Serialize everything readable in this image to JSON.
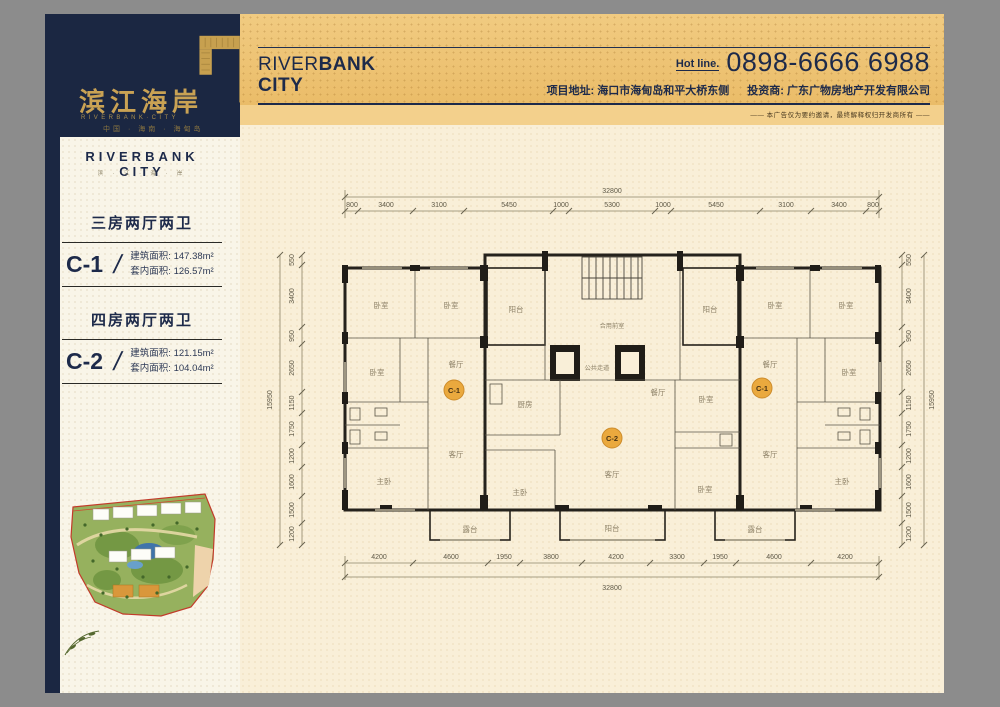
{
  "brand": {
    "logo_cn": "滨江海岸",
    "logo_en": "RIVERBANK·CITY",
    "logo_sub": "中国 · 海南 · 海甸岛",
    "navy": "#1b2742",
    "gold": "#c9a254"
  },
  "banner": {
    "brand_part1": "RIVER",
    "brand_part2": "BANK",
    "brand_part3": "CITY",
    "hotline_label": "Hot line.",
    "hotline_number": "0898-6666 6988",
    "address": "项目地址: 海口市海甸岛和平大桥东侧",
    "investor": "投资商: 广东广物房地产开发有限公司",
    "disclaimer": "—— 本广告仅为要约邀请，最终解释权归开发商所有 ——"
  },
  "sidebar": {
    "title": "RIVERBANK CITY",
    "subtitle": "滨 · 江 · 海 · 岸",
    "units": [
      {
        "type": "三房两厅两卫",
        "code": "C-1",
        "slash": "/",
        "build_label": "建筑面积:",
        "build_area": "147.38m²",
        "inner_label": "套内面积:",
        "inner_area": "126.57m²"
      },
      {
        "type": "四房两厅两卫",
        "code": "C-2",
        "slash": "/",
        "build_label": "建筑面积:",
        "build_area": "121.15m²",
        "inner_label": "套内面积:",
        "inner_area": "104.04m²"
      }
    ]
  },
  "floorplan": {
    "total_width": "32800",
    "total_height": "15950",
    "dims_top": [
      "800",
      "3400",
      "3100",
      "5450",
      "1000",
      "5300",
      "1000",
      "5450",
      "3100",
      "3400",
      "800"
    ],
    "dims_bottom": [
      "4200",
      "4600",
      "1950",
      "3800",
      "4200",
      "3300",
      "1950",
      "4600",
      "4200"
    ],
    "dims_side": [
      "550",
      "3400",
      "950",
      "2650",
      "1150",
      "1750",
      "1200",
      "1600",
      "1500",
      "1200"
    ],
    "badges": [
      "C-1",
      "C-2",
      "C-1"
    ],
    "rooms": {
      "bedroom": "卧室",
      "master": "主卧",
      "living": "客厅",
      "dining": "餐厅",
      "kitchen": "厨房",
      "balcony": "阳台",
      "terrace": "露台",
      "shared_front": "合用前室",
      "corridor": "公共走道"
    }
  }
}
